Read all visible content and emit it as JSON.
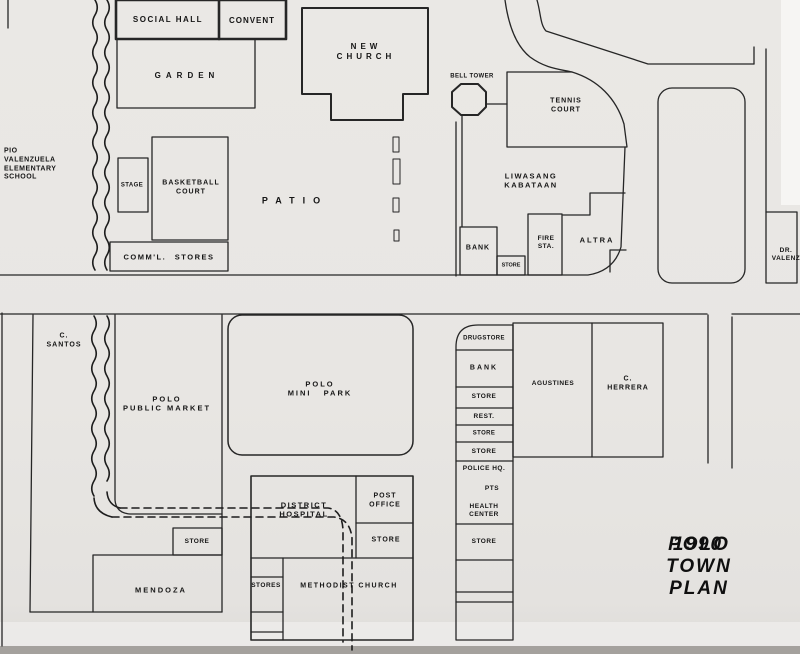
{
  "title": {
    "year": "1990",
    "name": "POLO TOWN PLAN"
  },
  "buildings": {
    "social_hall": "SOCIAL HALL",
    "convent": "CONVENT",
    "garden": "GARDEN",
    "new_church": "NEW\nCHURCH",
    "bell_tower": "BELL TOWER",
    "tennis_court": "TENNIS\nCOURT",
    "school": "PIO\nVALENZUELA\nELEMENTARY\nSCHOOL",
    "stage": "STAGE",
    "basketball_court": "BASKETBALL\nCOURT",
    "comml_stores": "COMM'L. STORES",
    "patio": "PATIO",
    "liwasang_kabataan": "LIWASANG\nKABATAAN",
    "bank_upper": "BANK",
    "store_upper": "STORE",
    "fire_station": "FIRE\nSTA.",
    "altra": "ALTRA",
    "dr_valenzuela": "DR.\nVALENZ",
    "c_santos": "C.\nSANTOS",
    "polo_public_market": "POLO\nPUBLIC MARKET",
    "polo_mini_park": "POLO\nMINI PARK",
    "drugstore": "DRUGSTORE",
    "bank_lower": "BANK",
    "store_row1": "STORE",
    "restaurant": "REST.",
    "store_row2": "STORE",
    "store_row3": "STORE",
    "police_hq": "POLICE HQ.",
    "pts": "PTS",
    "health_center": "HEALTH\nCENTER",
    "store_row4": "STORE",
    "agustines": "AGUSTINES",
    "c_herrera": "C.\nHERRERA",
    "market_store": "STORE",
    "mendoza": "MENDOZA",
    "district_hospital": "DISTRICT\nHOSPITAL",
    "post_office": "POST\nOFFICE",
    "hospital_store": "STORE",
    "stores_strip": "STORES",
    "methodist_church": "METHODIST CHURCH"
  }
}
